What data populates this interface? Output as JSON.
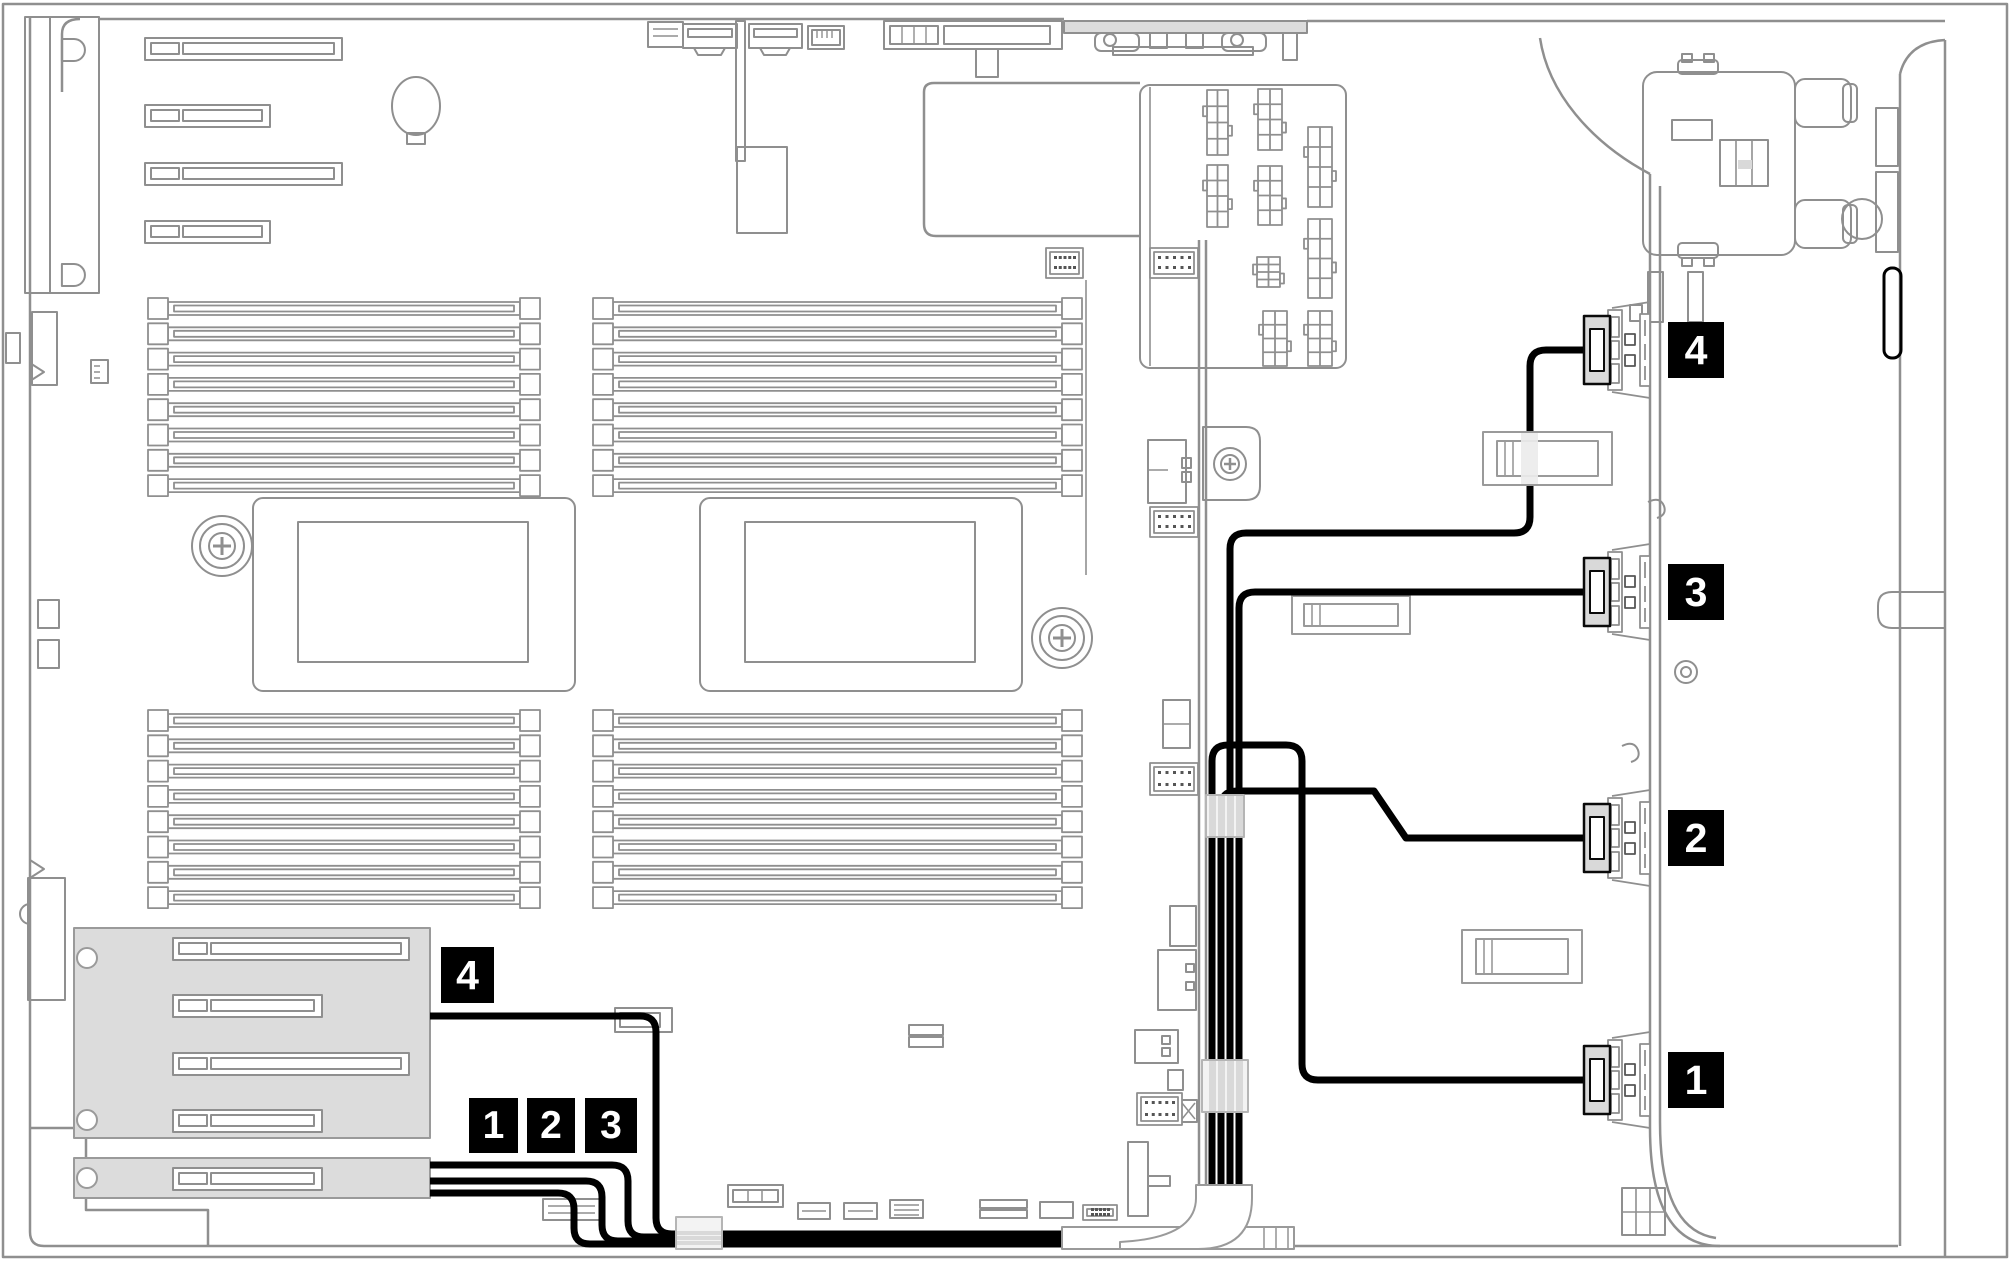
{
  "diagram_type": "server-internal-cable-routing-diagram",
  "colors": {
    "line": "#8f8f8f",
    "line_dark": "#6f6f6f",
    "black": "#000000",
    "gray_fill": "#dcdcdc",
    "plug_gray": "#d9d9d9",
    "clip_fill": "#f3f3f3",
    "clip_band": "#d9d9d9",
    "white": "#ffffff"
  },
  "callouts": {
    "right": [
      {
        "id": "r4",
        "label": "4"
      },
      {
        "id": "r3",
        "label": "3"
      },
      {
        "id": "r2",
        "label": "2"
      },
      {
        "id": "r1",
        "label": "1"
      }
    ],
    "left": [
      {
        "id": "l4",
        "label": "4"
      },
      {
        "id": "l1",
        "label": "1"
      },
      {
        "id": "l2",
        "label": "2"
      },
      {
        "id": "l3",
        "label": "3"
      }
    ]
  },
  "cables": [
    {
      "id": "cable-4",
      "path": "M 1584 350 H 1546 Q 1530 350 1530 366 V 517 Q 1530 533 1514 533 H 1246 Q 1230 533 1230 549 V 1218 Q 1230 1234 1214 1234 H 672 Q 656 1234 656 1218 V 1032 Q 656 1016 640 1016 H 430"
    },
    {
      "id": "cable-3",
      "path": "M 1584 592 H 1255 Q 1239 592 1239 608 V 1228 Q 1239 1244 1223 1244 H 590 Q 574 1244 574 1228 V 1209 Q 574 1193 558 1193 H 430"
    },
    {
      "id": "cable-2",
      "path": "M 1584 838 H 1406 L 1374 791 H 1237 Q 1221 791 1221 807 V 1225 Q 1221 1241 1205 1241 H 618 Q 602 1241 602 1225 V 1197 Q 602 1181 586 1181 H 430"
    },
    {
      "id": "cable-1",
      "path": "M 1584 1080 H 1318 Q 1302 1080 1302 1064 V 761 Q 1302 745 1286 745 H 1228 Q 1212 745 1212 761 V 1221 Q 1212 1237 1196 1237 H 644 Q 628 1237 628 1221 V 1181 Q 628 1165 612 1165 H 430"
    }
  ],
  "components": {
    "dimm_groups": [
      {
        "x1": 148,
        "x2": 540,
        "y": 298,
        "count": 8,
        "pitch": 25.3
      },
      {
        "x1": 593,
        "x2": 1082,
        "y": 298,
        "count": 8,
        "pitch": 25.3
      },
      {
        "x1": 148,
        "x2": 540,
        "y": 710,
        "count": 8,
        "pitch": 25.3
      },
      {
        "x1": 593,
        "x2": 1082,
        "y": 710,
        "count": 8,
        "pitch": 25.3
      }
    ],
    "pcie_slots_onboard": [
      {
        "x": 145,
        "y": 38,
        "w": 197
      },
      {
        "x": 145,
        "y": 105,
        "w": 125
      },
      {
        "x": 145,
        "y": 163,
        "w": 197
      },
      {
        "x": 145,
        "y": 221,
        "w": 125
      }
    ],
    "riser_slots": [
      {
        "x": 173,
        "y": 938,
        "w": 236
      },
      {
        "x": 173,
        "y": 995,
        "w": 149
      },
      {
        "x": 173,
        "y": 1053,
        "w": 236
      },
      {
        "x": 173,
        "y": 1110,
        "w": 149
      },
      {
        "x": 173,
        "y": 1168,
        "w": 149
      }
    ],
    "psu_connectors": [
      [
        1207,
        90,
        21,
        65
      ],
      [
        1258,
        89,
        24,
        61
      ],
      [
        1308,
        127,
        24,
        80
      ],
      [
        1207,
        165,
        21,
        62
      ],
      [
        1258,
        166,
        24,
        59
      ],
      [
        1308,
        219,
        24,
        79
      ],
      [
        1257,
        257,
        23,
        30
      ],
      [
        1263,
        311,
        24,
        55
      ],
      [
        1308,
        311,
        24,
        55
      ]
    ],
    "pin_headers": [
      [
        1046,
        248,
        37,
        30
      ],
      [
        1150,
        248,
        48,
        30
      ],
      [
        1150,
        507,
        48,
        30
      ],
      [
        1150,
        763,
        48,
        32
      ],
      [
        1137,
        1093,
        45,
        32
      ],
      [
        1083,
        1205,
        34,
        15
      ]
    ],
    "backplane_ports_cy": [
      350,
      592,
      838,
      1080
    ]
  }
}
